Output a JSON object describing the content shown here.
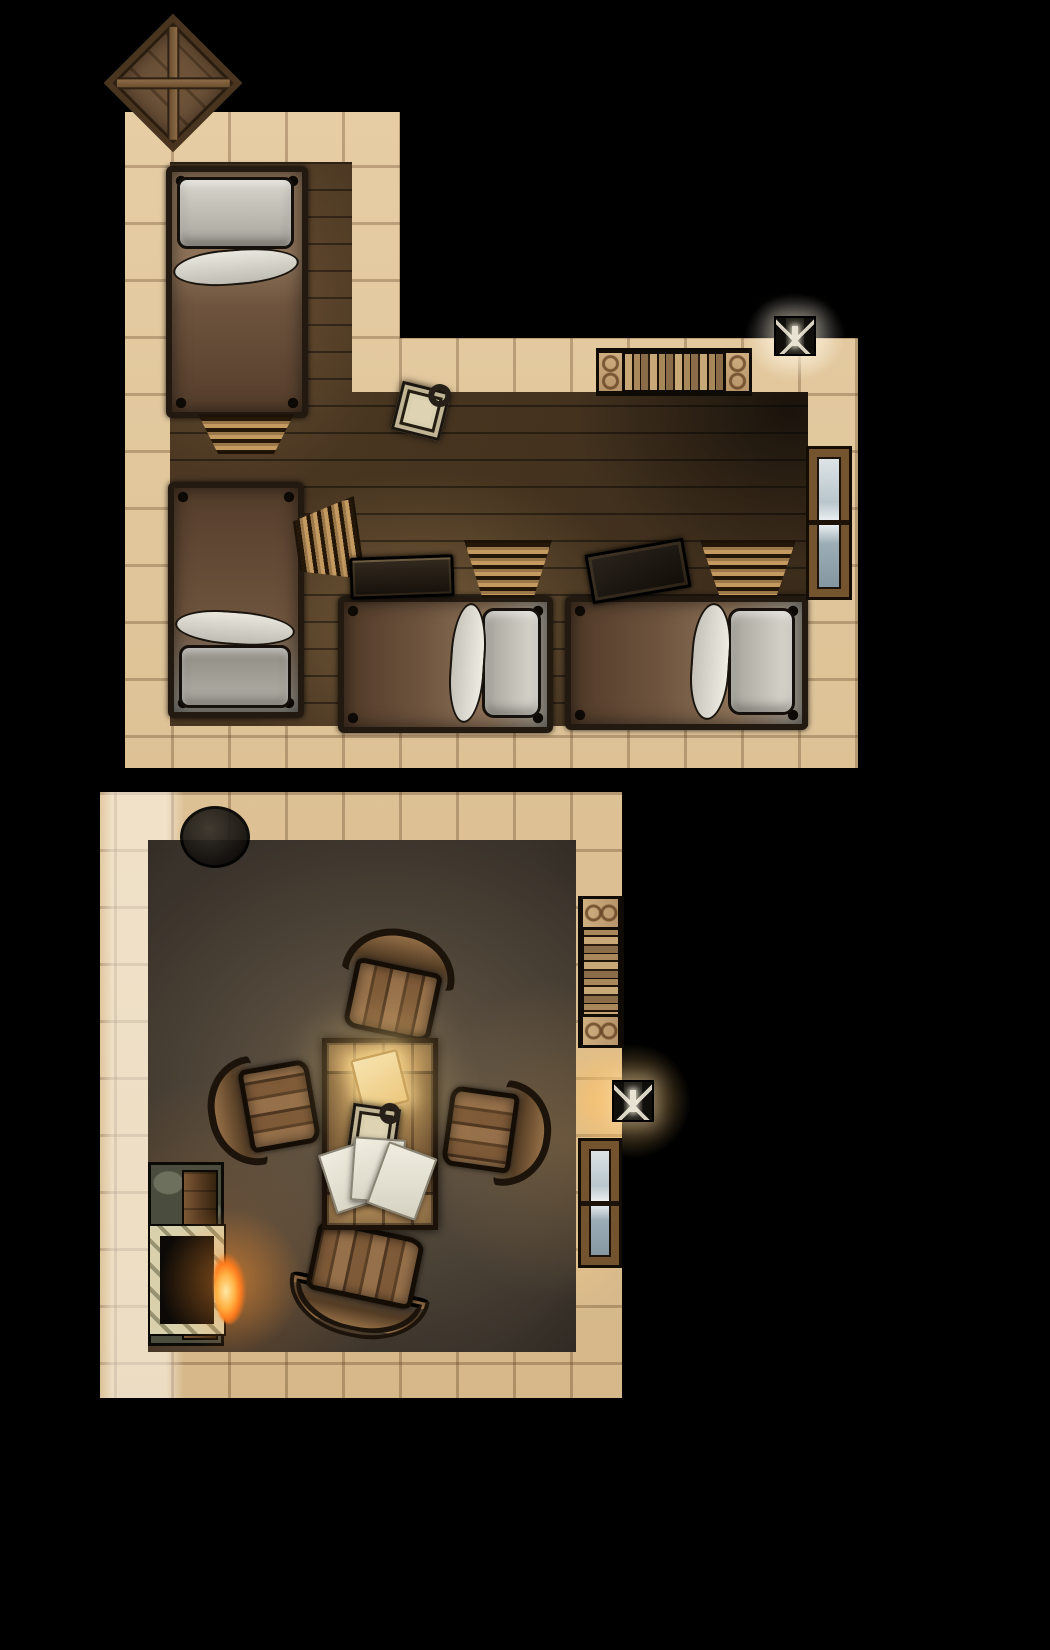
{
  "meta": {
    "description": "top-down fantasy battle map of a two-room inn: an L-shaped bunk room with four beds and a common room with a table, chairs and fireplace",
    "canvas": {
      "width": 1050,
      "height": 1650
    },
    "background": "#000000"
  },
  "palette": {
    "stone_wall": "#dcc096",
    "wood_floor": "#46341f",
    "plaster_floor": "#3a332b",
    "bed_blanket": "#6e543e",
    "linen": "#d7d4cb",
    "table_wood": "#8a6840",
    "fire": "#ff9a33",
    "torch_glow": "#ffc87a",
    "window_glass": "#c7d3d8"
  },
  "rooms": [
    {
      "name": "bunk-room",
      "wall_class": "wall-bunk",
      "floor_class": "floor-wood",
      "outer": "125px 112px,400px 112px,400px 338px,858px 338px,858px 768px,125px 768px",
      "inner": "170px 162px,352px 162px,352px 392px,808px 392px,808px 726px,170px 726px"
    },
    {
      "name": "common-room",
      "wall_class": "wall-common",
      "floor_class": "floor-plaster",
      "outer": "100px 792px,622px 792px,622px 1398px,100px 1398px",
      "inner": "148px 840px,576px 840px,576px 1352px,148px 1352px"
    }
  ],
  "furniture": [
    {
      "type": "crate",
      "name": "storage-crate-outside",
      "x": 124,
      "y": 34,
      "w": 98,
      "h": 98,
      "rot": 45
    },
    {
      "type": "bed",
      "variant": "bed-pillow-top",
      "name": "bed-top-left",
      "x": 166,
      "y": 166,
      "w": 142,
      "h": 252,
      "rot": 0
    },
    {
      "type": "ladder",
      "variant": "ladder-taper-down",
      "name": "bed-steps",
      "x": 198,
      "y": 414,
      "w": 96,
      "h": 40,
      "rot": 0
    },
    {
      "type": "bed",
      "variant": "bed-pillow-bottom",
      "name": "bed-mid-left",
      "x": 168,
      "y": 482,
      "w": 136,
      "h": 236,
      "rot": 0
    },
    {
      "type": "ladder",
      "variant": "ladder-side-right",
      "name": "bunk-ladder-west",
      "x": 296,
      "y": 500,
      "w": 64,
      "h": 84,
      "rot": -8
    },
    {
      "type": "bed",
      "variant": "bed-pillow-right",
      "name": "bed-south-center",
      "x": 338,
      "y": 596,
      "w": 215,
      "h": 137,
      "rot": 0
    },
    {
      "type": "bed",
      "variant": "bed-pillow-right",
      "name": "bed-south-east",
      "x": 565,
      "y": 596,
      "w": 243,
      "h": 134,
      "rot": 0
    },
    {
      "type": "chest",
      "name": "storage-chest",
      "x": 350,
      "y": 556,
      "w": 104,
      "h": 42,
      "rot": -2
    },
    {
      "type": "crate-flat",
      "name": "crate-lid",
      "x": 588,
      "y": 546,
      "w": 100,
      "h": 50,
      "rot": -10
    },
    {
      "type": "ladder",
      "variant": "ladder-taper-down",
      "name": "bunk-ladder-center",
      "x": 464,
      "y": 540,
      "w": 88,
      "h": 58,
      "rot": 0
    },
    {
      "type": "ladder",
      "variant": "ladder-taper-down",
      "name": "bunk-ladder-east",
      "x": 700,
      "y": 540,
      "w": 96,
      "h": 58,
      "rot": 0
    },
    {
      "type": "lantern",
      "name": "floor-lantern",
      "x": 396,
      "y": 386,
      "w": 50,
      "h": 50,
      "rot": 14
    },
    {
      "type": "shelf-books-h",
      "name": "wall-bookshelf-north",
      "x": 596,
      "y": 348,
      "w": 156,
      "h": 48,
      "rot": 0
    },
    {
      "type": "glow",
      "name": "torch-glow-north",
      "x": 725,
      "y": 276,
      "w": 140,
      "h": 120,
      "rot": 0,
      "glow_color": "rgba(255,252,240,0.5)"
    },
    {
      "type": "sconce",
      "name": "wall-torch-north",
      "x": 774,
      "y": 316,
      "w": 42,
      "h": 40,
      "rot": 0
    },
    {
      "type": "window-v",
      "name": "window-east",
      "x": 806,
      "y": 446,
      "w": 46,
      "h": 154,
      "rot": 0
    },
    {
      "type": "cauldron",
      "name": "cauldron",
      "x": 180,
      "y": 806,
      "w": 70,
      "h": 62,
      "rot": 0
    },
    {
      "type": "shelf-books-v",
      "name": "wall-bookshelf-east",
      "x": 578,
      "y": 896,
      "w": 46,
      "h": 152,
      "rot": 0
    },
    {
      "type": "glow",
      "name": "torch-glow-east",
      "x": 553,
      "y": 1021,
      "w": 160,
      "h": 160,
      "rot": 0,
      "glow_color": "rgba(255,200,110,0.55)"
    },
    {
      "type": "sconce",
      "name": "wall-torch-east",
      "x": 612,
      "y": 1080,
      "w": 42,
      "h": 42,
      "rot": 0
    },
    {
      "type": "window-v",
      "name": "window-south-east",
      "x": 578,
      "y": 1138,
      "w": 44,
      "h": 130,
      "rot": 0
    },
    {
      "type": "fireplace-base",
      "name": "fireplace",
      "x": 148,
      "y": 1162,
      "w": 76,
      "h": 184,
      "rot": 0
    },
    {
      "type": "fireplace-plank",
      "name": "fireplace-mantel",
      "x": 182,
      "y": 1170,
      "w": 36,
      "h": 170,
      "rot": 0
    },
    {
      "type": "fireplace-firebox",
      "name": "fireplace-hearth",
      "x": 150,
      "y": 1226,
      "w": 74,
      "h": 108,
      "rot": 0
    },
    {
      "type": "glow",
      "name": "fire-glow",
      "x": 131,
      "y": 1181,
      "w": 200,
      "h": 200,
      "rot": 0,
      "glow_color": "rgba(255,150,50,0.5)"
    },
    {
      "type": "fire",
      "name": "hearth-fire",
      "x": 214,
      "y": 1238,
      "w": 34,
      "h": 86,
      "rot": 0
    },
    {
      "type": "chair",
      "name": "chair-north",
      "x": 344,
      "y": 942,
      "w": 102,
      "h": 96,
      "rot": 12
    },
    {
      "type": "chair",
      "name": "chair-west",
      "x": 220,
      "y": 1060,
      "w": 98,
      "h": 96,
      "rot": -100
    },
    {
      "type": "chair",
      "name": "chair-east",
      "x": 444,
      "y": 1084,
      "w": 94,
      "h": 94,
      "rot": 98
    },
    {
      "type": "chair",
      "variant": "chair-large",
      "name": "chair-south",
      "x": 300,
      "y": 1226,
      "w": 126,
      "h": 98,
      "rot": 192
    },
    {
      "type": "table",
      "name": "common-table",
      "x": 322,
      "y": 1038,
      "w": 116,
      "h": 192,
      "rot": 0
    },
    {
      "type": "parchment",
      "name": "glowing-parchment",
      "x": 356,
      "y": 1054,
      "w": 48,
      "h": 54,
      "rot": -14
    },
    {
      "type": "lantern",
      "name": "table-lantern",
      "x": 350,
      "y": 1106,
      "w": 48,
      "h": 48,
      "rot": 8
    },
    {
      "type": "paper",
      "name": "paper-1",
      "x": 326,
      "y": 1146,
      "w": 50,
      "h": 62,
      "rot": -18
    },
    {
      "type": "paper",
      "name": "paper-2",
      "x": 352,
      "y": 1138,
      "w": 52,
      "h": 64,
      "rot": 4
    },
    {
      "type": "paper",
      "name": "paper-3",
      "x": 376,
      "y": 1148,
      "w": 52,
      "h": 66,
      "rot": 20
    }
  ]
}
